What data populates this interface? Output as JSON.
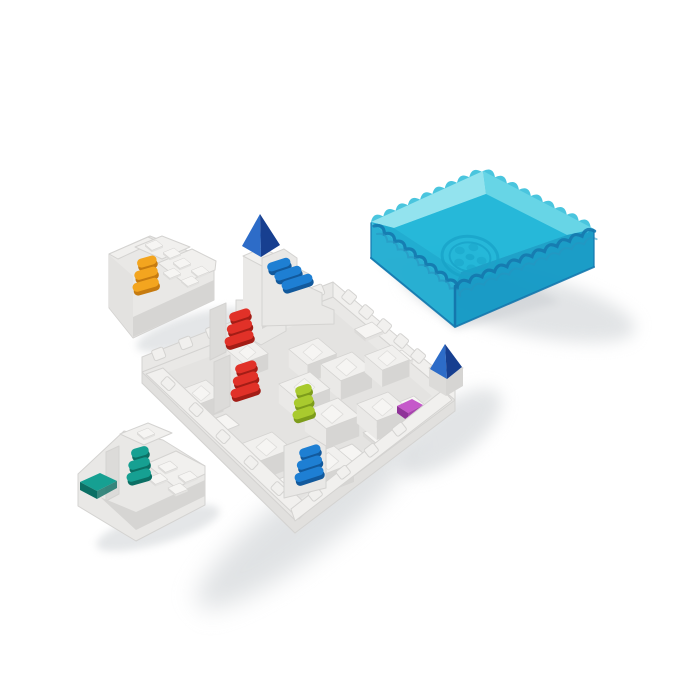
{
  "scene": {
    "description": "Product photo of a white castle-themed sliding-stairs puzzle game: a square white board with towers, colored staircases and two loose stair pieces, next to a translucent blue square storage tray with a wavy crenellated rim and an embossed wheel logo",
    "background": "plain white studio backdrop"
  },
  "colors": {
    "white_bg": "#ffffff",
    "plastic": "#e9e8e6",
    "plastic_light": "#f1f0ee",
    "plastic_bright": "#f6f5f3",
    "plastic_mid": "#dcdbd9",
    "plastic_mid2": "#e3e2e0",
    "plastic_faceL": "#eae9e7",
    "plastic_faceR": "#d6d5d3",
    "plastic_skirt": "#e1e0de",
    "plastic_field": "#e4e3e1",
    "plastic_hole": "#b5b4b2",
    "plastic_edge": "#d4d3d1",
    "plastic_edge2": "#dedddb",
    "shadow": "#d6d9dc",
    "shadow_dark": "#c5c9ce",
    "tray_rim": "#45c4dd",
    "tray_rim_light": "#90e3ee",
    "tray_rim_light2": "#63d4e6",
    "tray_floor": "#1fb6d8",
    "tray_wall": "#23aed2",
    "tray_wall_deep": "#149ac6",
    "tray_inner_front": "#1aabd0",
    "tray_inner_front2": "#189fc8",
    "tray_edge": "#0e74ac",
    "tray_wave2": "#2191c0",
    "tray_logo": "#12a2c8",
    "pyramid_light": "#2d6cc8",
    "pyramid_dark": "#173f90",
    "stair_blue": "#1e7fd3",
    "stair_blue_dark": "#12599c",
    "stair_red": "#e13128",
    "stair_red_dark": "#a31d16",
    "stair_orange": "#f3a51f",
    "stair_orange_dark": "#c67b10",
    "stair_lime": "#a9ca2e",
    "stair_lime_dark": "#7d9c1b",
    "stair_teal": "#16a092",
    "stair_teal_dark": "#0c6f64",
    "tile_purple": "#c558ca",
    "tile_purple_dark": "#8f3398",
    "tile_purple_side": "#a843ae",
    "tile_teal": "#16a092",
    "tile_teal_dark": "#0c6f64"
  },
  "objects": {
    "tray": {
      "name": "translucent-blue-storage-tray",
      "rim_style": "wavy-crenellated",
      "emblem": "embossed-wheel-logo"
    },
    "board": {
      "name": "white-puzzle-board",
      "rim_style": "castle-crenellated",
      "towers_with_pyramid_tops": 2
    },
    "staircases_on_board": [
      {
        "id": "tower-staircase",
        "color": "blue"
      },
      {
        "id": "upper-staircase",
        "color": "red"
      },
      {
        "id": "middle-staircase",
        "color": "red"
      },
      {
        "id": "center-staircase",
        "color": "lime"
      },
      {
        "id": "bottom-staircase",
        "color": "blue"
      }
    ],
    "tiles_on_board": [
      {
        "id": "ramp-tile",
        "color": "purple"
      }
    ],
    "loose_pieces": [
      {
        "id": "orange-stairs-piece",
        "stair_color": "orange"
      },
      {
        "id": "teal-stairs-piece",
        "stair_color": "teal",
        "extra_tile_color": "teal"
      }
    ]
  }
}
